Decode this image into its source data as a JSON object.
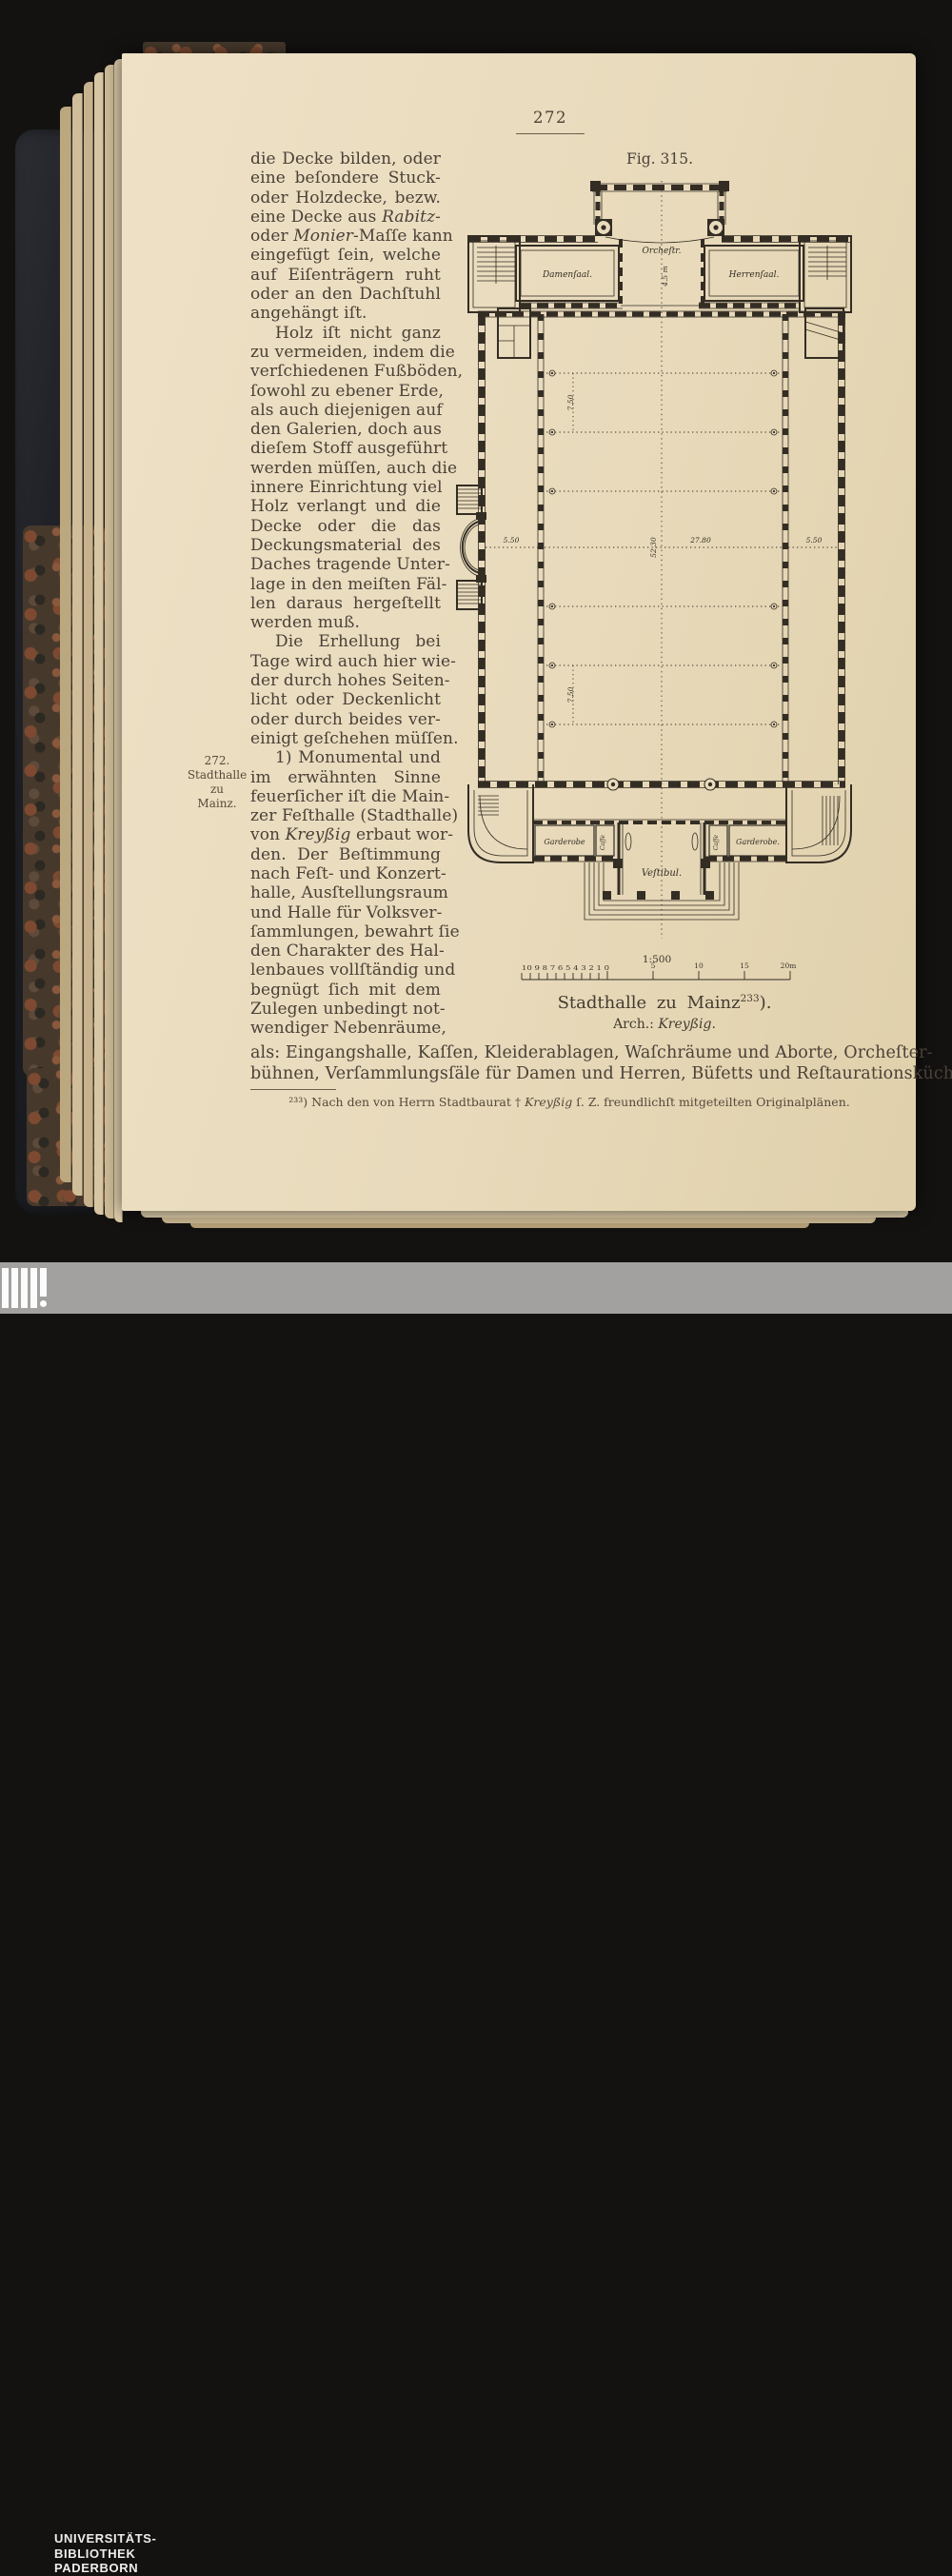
{
  "header": {
    "page_number": "272",
    "figure_label": "Fig. 315."
  },
  "margin_note": {
    "l1": "272.",
    "l2": "Stadthalle",
    "l3": "zu",
    "l4": "Mainz."
  },
  "left_column": {
    "lines": [
      "die Decke bilden, oder",
      "eine beſondere Stuck-",
      "oder Holzdecke, bezw.",
      {
        "pre": "eine Decke aus ",
        "it": "Rabitz",
        "post": "-"
      },
      {
        "pre": "oder ",
        "it": "Monier",
        "post": "-Maſſe kann"
      },
      "eingefügt ſein, welche",
      "auf Eiſenträgern ruht",
      "oder an den Dachſtuhl",
      "angehängt iſt.",
      "Holz iſt nicht ganz",
      "zu vermeiden, indem die",
      "verſchiedenen Fußböden,",
      "ſowohl zu ebener Erde,",
      "als auch diejenigen auf",
      "den Galerien, doch aus",
      "dieſem Stoff ausgeführt",
      "werden müſſen, auch die",
      "innere Einrichtung viel",
      "Holz verlangt und die",
      "Decke oder die das",
      "Deckungsmaterial des",
      "Daches tragende Unter-",
      "lage in den meiſten Fäl-",
      "len daraus hergeſtellt",
      "werden muß.",
      "Die Erhellung bei",
      "Tage wird auch hier wie-",
      "der durch hohes Seiten-",
      "licht oder Deckenlicht",
      "oder durch beides ver-",
      "einigt geſchehen müſſen.",
      "1) Monumental und",
      "im erwähnten Sinne",
      "feuerſicher iſt die Main-",
      "zer Feſthalle (Stadthalle)",
      {
        "pre": "von ",
        "it": "Kreyßig",
        "post": " erbaut wor-"
      },
      "den.  Der Beſtimmung",
      "nach Feſt- und Konzert-",
      "halle,  Ausſtellungsraum",
      "und Halle für Volksver-",
      "ſammlungen, bewahrt ſie",
      "den Charakter des Hal-",
      "lenbaues vollſtändig und",
      "begnügt ſich mit dem",
      "Zulegen unbedingt not-",
      "wendiger Nebenräume,"
    ]
  },
  "wide_lines": {
    "l1": "als: Eingangshalle, Kaſſen, Kleiderablagen, Waſchräume und Aborte, Orcheſter-",
    "l2": "bühnen, Verſammlungsſäle für Damen und Herren, Büfetts und Reſtaurationsküche,"
  },
  "footnote": {
    "pre": "²³³) Nach den von Herrn Stadtbaurat † ",
    "it": "Kreyßig",
    "post": " ſ. Z. freundlichſt mitgeteilten Originalplänen."
  },
  "plan": {
    "labels": {
      "orchestra": "Orcheſtr.",
      "damensaal": "Damenſaal.",
      "herrensaal": "Herrenſaal.",
      "garderobe_left": "Garderobe",
      "garderobe_right": "Garderobe.",
      "casse_left": "Caſſe",
      "casse_right": "Caſſe",
      "vestibul": "Veſtibul."
    },
    "dims": {
      "aisle_left": "5.50",
      "aisle_right": "5.50",
      "hall_width": "27.80",
      "hall_length": "52.30",
      "bay_upper": "7.50",
      "bay_lower": "7.50",
      "orchestra_depth": "4.5 m"
    }
  },
  "scale": {
    "ratio": "1:500",
    "minor": "10 9 8 7 6 5 4 3 2 1 0",
    "m5": "5",
    "m10": "10",
    "m15": "15",
    "m20": "20m"
  },
  "caption": {
    "line1": "Stadthalle zu Mainz",
    "sup": "233",
    "close": ").",
    "arch_pre": "Arch.: ",
    "arch_it": "Kreyßig",
    "arch_post": "."
  },
  "library_stamp": {
    "l1": "UNIVERSITÄTS-",
    "l2": "BIBLIOTHEK",
    "l3": "PADERBORN"
  }
}
